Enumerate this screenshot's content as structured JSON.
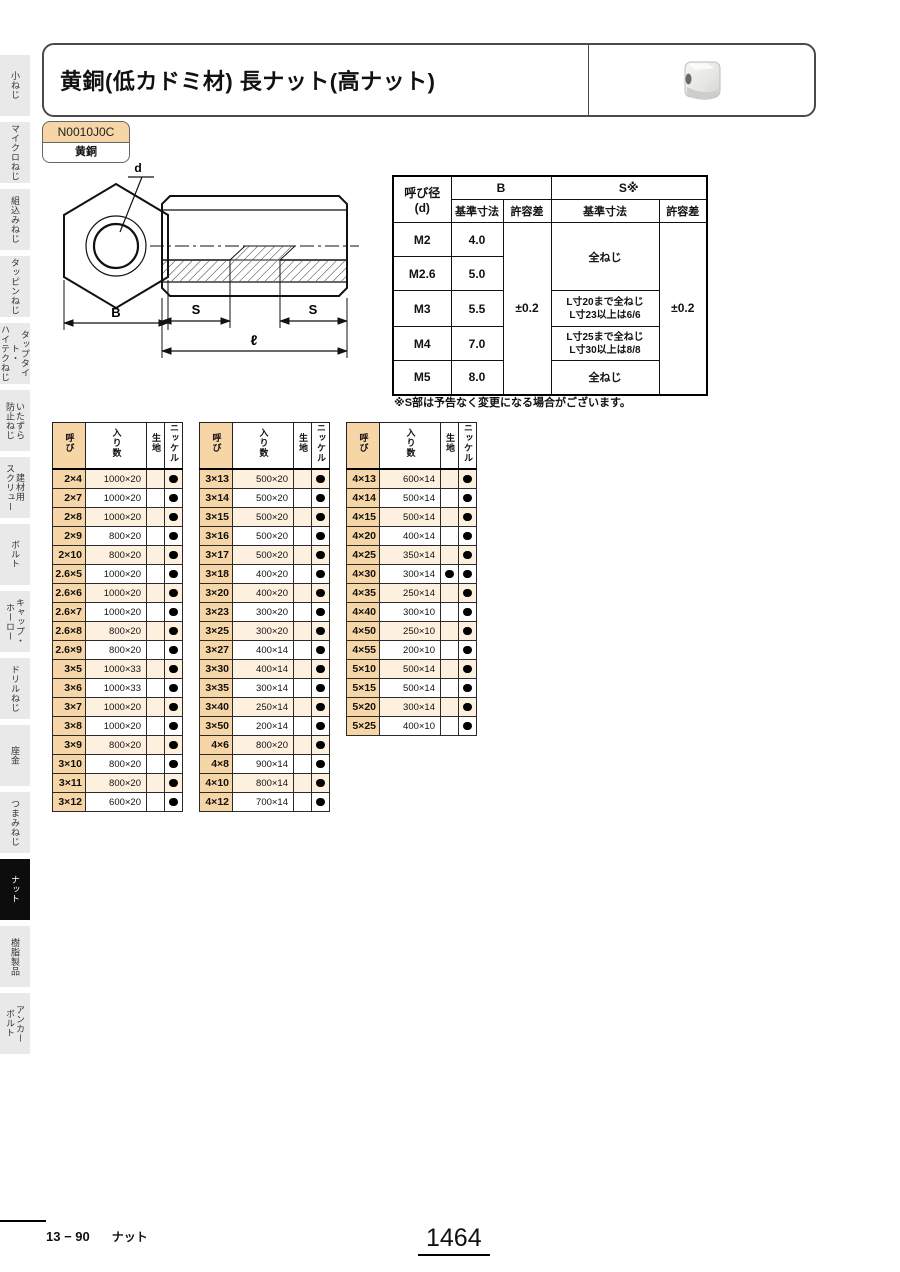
{
  "sidebar": {
    "items": [
      {
        "label": "小ねじ",
        "active": false
      },
      {
        "label": "マイクロねじ",
        "active": false
      },
      {
        "label": "組込みねじ",
        "active": false
      },
      {
        "label": "タッピンねじ",
        "active": false
      },
      {
        "label": "タップタイト・\nハイテクねじ",
        "active": false
      },
      {
        "label": "いたずら\n防止ねじ",
        "active": false
      },
      {
        "label": "建材用\nスクリュー",
        "active": false
      },
      {
        "label": "ボルト",
        "active": false
      },
      {
        "label": "キャップ・\nホーロー",
        "active": false
      },
      {
        "label": "ドリルねじ",
        "active": false
      },
      {
        "label": "座金",
        "active": false
      },
      {
        "label": "つまみねじ",
        "active": false
      },
      {
        "label": "ナット",
        "active": true
      },
      {
        "label": "樹脂製品",
        "active": false
      },
      {
        "label": "アンカー\nボルト",
        "active": false
      }
    ]
  },
  "header": {
    "title": "黄銅(低カドミ材) 長ナット(高ナット)"
  },
  "badge": {
    "code": "N0010J0C",
    "material": "黄銅"
  },
  "drawing": {
    "labels": {
      "d": "d",
      "b": "B",
      "s": "S",
      "length": "ℓ"
    }
  },
  "spec_table": {
    "header": {
      "col_d": "呼び径\n(d)",
      "col_b": "B",
      "col_s": "S※",
      "sub_basic": "基準寸法",
      "sub_tol": "許容差"
    },
    "b_tolerance": "±0.2",
    "s_tolerance": "±0.2",
    "s_m2_m26": "全ねじ",
    "rows": [
      {
        "d": "M2",
        "b": "4.0"
      },
      {
        "d": "M2.6",
        "b": "5.0"
      },
      {
        "d": "M3",
        "b": "5.5",
        "s": "L寸20まで全ねじ\nL寸23以上は6/6"
      },
      {
        "d": "M4",
        "b": "7.0",
        "s": "L寸25まで全ねじ\nL寸30以上は8/8"
      },
      {
        "d": "M5",
        "b": "8.0",
        "s": "全ねじ"
      }
    ],
    "note": "※S部は予告なく変更になる場合がございます。"
  },
  "product_tables": {
    "headers": {
      "size": "呼び",
      "qty": "入り数",
      "plain": "生地",
      "nickel": "ニッケル"
    },
    "tables": [
      {
        "rows": [
          [
            "2×4",
            "1000×20",
            false,
            true
          ],
          [
            "2×7",
            "1000×20",
            false,
            true
          ],
          [
            "2×8",
            "1000×20",
            false,
            true
          ],
          [
            "2×9",
            "800×20",
            false,
            true
          ],
          [
            "2×10",
            "800×20",
            false,
            true
          ],
          [
            "2.6×5",
            "1000×20",
            false,
            true
          ],
          [
            "2.6×6",
            "1000×20",
            false,
            true
          ],
          [
            "2.6×7",
            "1000×20",
            false,
            true
          ],
          [
            "2.6×8",
            "800×20",
            false,
            true
          ],
          [
            "2.6×9",
            "800×20",
            false,
            true
          ],
          [
            "3×5",
            "1000×33",
            false,
            true
          ],
          [
            "3×6",
            "1000×33",
            false,
            true
          ],
          [
            "3×7",
            "1000×20",
            false,
            true
          ],
          [
            "3×8",
            "1000×20",
            false,
            true
          ],
          [
            "3×9",
            "800×20",
            false,
            true
          ],
          [
            "3×10",
            "800×20",
            false,
            true
          ],
          [
            "3×11",
            "800×20",
            false,
            true
          ],
          [
            "3×12",
            "600×20",
            false,
            true
          ]
        ]
      },
      {
        "rows": [
          [
            "3×13",
            "500×20",
            false,
            true
          ],
          [
            "3×14",
            "500×20",
            false,
            true
          ],
          [
            "3×15",
            "500×20",
            false,
            true
          ],
          [
            "3×16",
            "500×20",
            false,
            true
          ],
          [
            "3×17",
            "500×20",
            false,
            true
          ],
          [
            "3×18",
            "400×20",
            false,
            true
          ],
          [
            "3×20",
            "400×20",
            false,
            true
          ],
          [
            "3×23",
            "300×20",
            false,
            true
          ],
          [
            "3×25",
            "300×20",
            false,
            true
          ],
          [
            "3×27",
            "400×14",
            false,
            true
          ],
          [
            "3×30",
            "400×14",
            false,
            true
          ],
          [
            "3×35",
            "300×14",
            false,
            true
          ],
          [
            "3×40",
            "250×14",
            false,
            true
          ],
          [
            "3×50",
            "200×14",
            false,
            true
          ],
          [
            "4×6",
            "800×20",
            false,
            true
          ],
          [
            "4×8",
            "900×14",
            false,
            true
          ],
          [
            "4×10",
            "800×14",
            false,
            true
          ],
          [
            "4×12",
            "700×14",
            false,
            true
          ]
        ]
      },
      {
        "rows": [
          [
            "4×13",
            "600×14",
            false,
            true
          ],
          [
            "4×14",
            "500×14",
            false,
            true
          ],
          [
            "4×15",
            "500×14",
            false,
            true
          ],
          [
            "4×20",
            "400×14",
            false,
            true
          ],
          [
            "4×25",
            "350×14",
            false,
            true
          ],
          [
            "4×30",
            "300×14",
            true,
            true
          ],
          [
            "4×35",
            "250×14",
            false,
            true
          ],
          [
            "4×40",
            "300×10",
            false,
            true
          ],
          [
            "4×50",
            "250×10",
            false,
            true
          ],
          [
            "4×55",
            "200×10",
            false,
            true
          ],
          [
            "5×10",
            "500×14",
            false,
            true
          ],
          [
            "5×15",
            "500×14",
            false,
            true
          ],
          [
            "5×20",
            "300×14",
            false,
            true
          ],
          [
            "5×25",
            "400×10",
            false,
            true
          ]
        ]
      }
    ]
  },
  "footer": {
    "section": "13 − 90",
    "category": "ナット",
    "page_number": "1464"
  }
}
